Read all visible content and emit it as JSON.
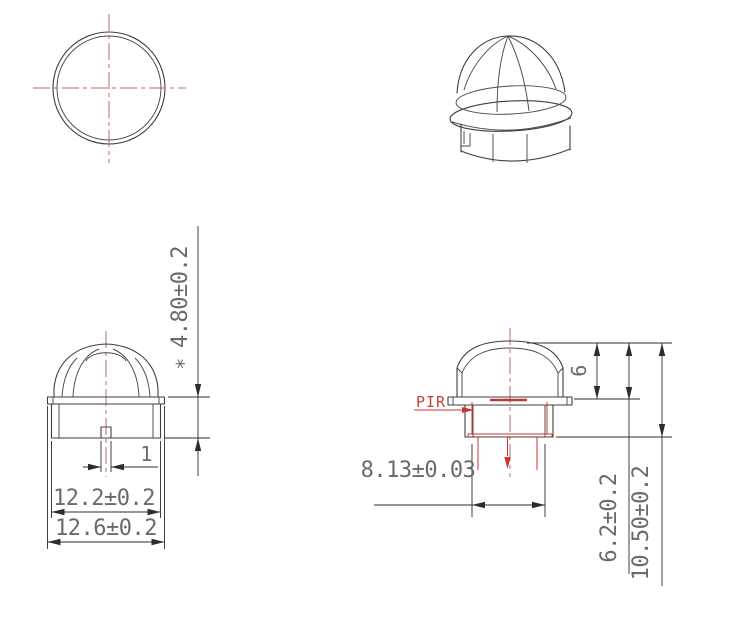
{
  "drawing": {
    "background": "#ffffff",
    "labels": {
      "pir": "PIR",
      "skirt_height": "4.80±0.2",
      "skirt_height_note": "*",
      "notch_width": "1",
      "body_diameter": "12.2±0.2",
      "flange_diameter": "12.6±0.2",
      "dome_height": "6",
      "pir_diameter": "8.13±0.03",
      "flange_height": "6.2±0.2",
      "total_height": "10.50±0.2"
    },
    "colors": {
      "outline": "#3f3f3f",
      "dimension_lines": "#2c2c2c",
      "dimension_text": "#6a6a6a",
      "centerline_red": "#b36b6b",
      "pir_red": "#cc3333"
    }
  }
}
